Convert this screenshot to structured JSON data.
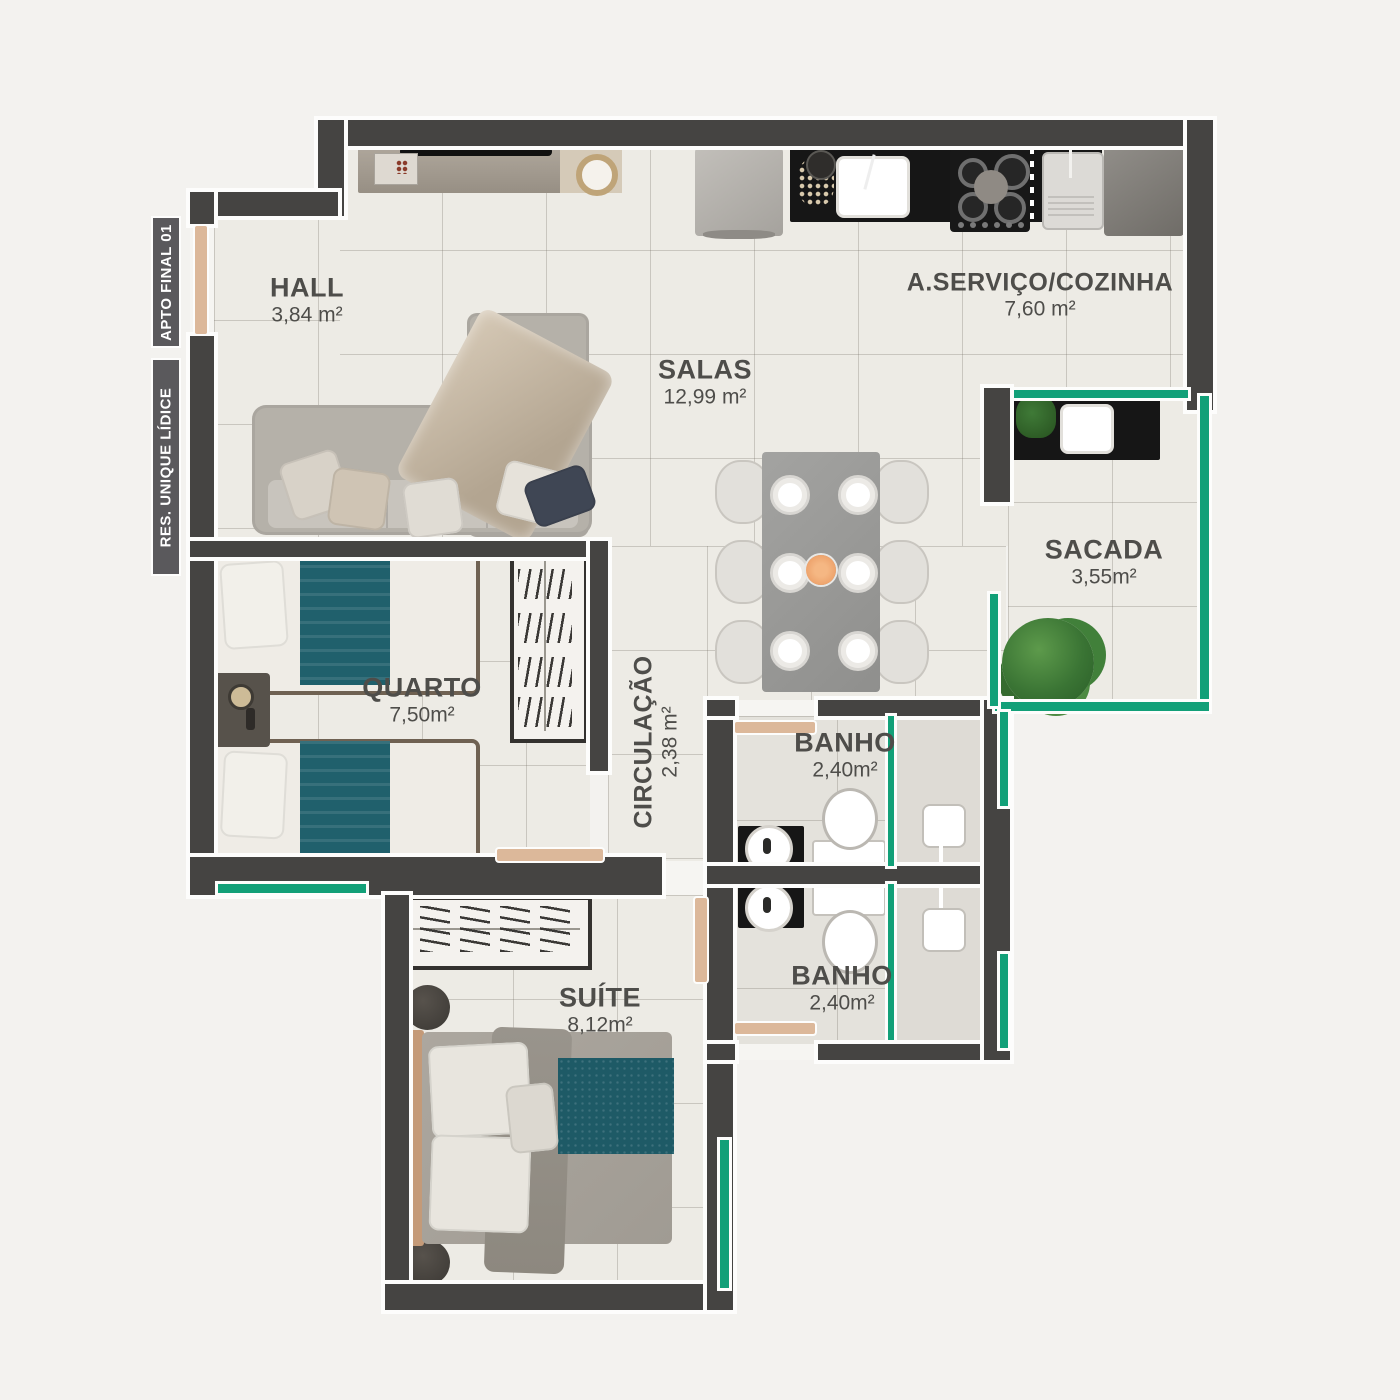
{
  "project": {
    "badges": [
      {
        "label": "APTO FINAL 01"
      },
      {
        "label": "RES. UNIQUE LÍDICE"
      }
    ]
  },
  "rooms": {
    "hall": {
      "name": "HALL",
      "area": "3,84 m²"
    },
    "salas": {
      "name": "SALAS",
      "area": "12,99 m²"
    },
    "servico_cozinha": {
      "name": "A.SERVIÇO/COZINHA",
      "area": "7,60 m²"
    },
    "sacada": {
      "name": "SACADA",
      "area": "3,55m²"
    },
    "quarto": {
      "name": "QUARTO",
      "area": "7,50m²"
    },
    "circulacao": {
      "name": "CIRCULAÇÃO",
      "area": "2,38 m²"
    },
    "banho_1": {
      "name": "BANHO",
      "area": "2,40m²"
    },
    "banho_2": {
      "name": "BANHO",
      "area": "2,40m²"
    },
    "suite": {
      "name": "SUÍTE",
      "area": "8,12m²"
    }
  },
  "colors": {
    "wall": "#454442",
    "floor": "#edebe5",
    "glass_accent": "#12a078",
    "door_wood": "#dcb89a",
    "counter_black": "#161616",
    "bedding_teal": "#20606c",
    "label_text": "#4e4d4a",
    "badge_bg": "#5a595c"
  }
}
